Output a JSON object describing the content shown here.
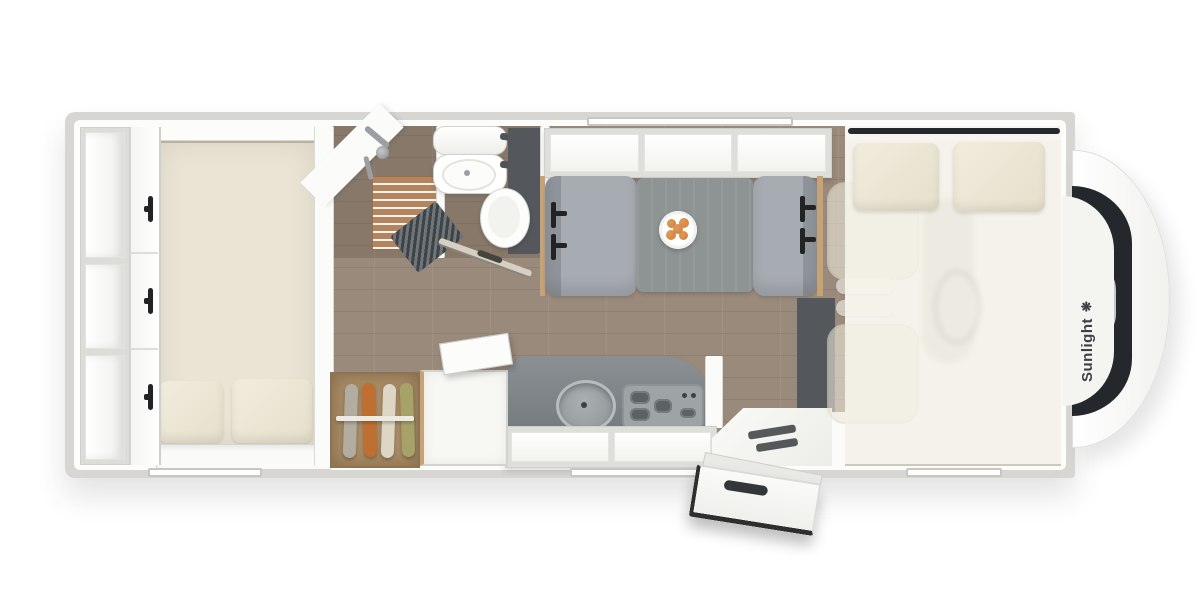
{
  "brand": {
    "name": "Sunlight",
    "logo_glyph": "❋"
  },
  "palette": {
    "bg": "#ffffff",
    "wall-outer": "#d7d6d3",
    "wall-face": "#fcfcfa",
    "bed-floor": "#eae4d5",
    "pillow": "#f1ecdd",
    "wood-floor": "#9a8a7b",
    "slat-wood": "#b3845e",
    "oak-trim": "#c6a377",
    "dark-panel": "#54585c",
    "bench": "#a7acb2",
    "bench-dark": "#8e949a",
    "table": "#8e9394",
    "counter": "#767c7f",
    "steel": "#9ea4a6",
    "belt": "#232323",
    "toilet": "#fdfdfb",
    "cab-seat": "#ece8db",
    "brand-text": "#3c4146",
    "glass": "#24272b",
    "food": "#cd7f3c",
    "cloth-gray": "#b3aca0",
    "cloth-orange": "#bf7030",
    "cloth-cream": "#ddd6c4",
    "cloth-olive": "#a7a368",
    "window-frame": "#c6c6c3"
  },
  "floorplan": {
    "view": "top-down",
    "vehicle": "motorhome",
    "zones": [
      {
        "id": "rear-bedroom",
        "items": [
          "bed",
          "two-pillows",
          "wardrobe-cabinets",
          "open-shelves",
          "foot-shelf",
          "window"
        ]
      },
      {
        "id": "bathroom",
        "items": [
          "shower-with-teak-grate",
          "shower-fixture",
          "washbasin-with-mirror",
          "toilet",
          "folding-door",
          "dark-partition"
        ]
      },
      {
        "id": "midship",
        "items": [
          "hanging-wardrobe-with-four-garments",
          "refrigerator-with-open-lid",
          "kitchen-counter",
          "round-sink",
          "three-burner-hob",
          "overhead-lockers",
          "window"
        ]
      },
      {
        "id": "dinette",
        "items": [
          "two-bench-seats-with-seatbelts",
          "table",
          "plate-of-food",
          "three-overhead-lockers",
          "window"
        ]
      },
      {
        "id": "entrance",
        "items": [
          "open-entry-door-with-handle",
          "entry-step",
          "dark-step-well"
        ]
      },
      {
        "id": "cab",
        "items": [
          "driver-seat",
          "passenger-seat",
          "steering-wheel",
          "dashboard",
          "drop-down-bed",
          "two-pillows",
          "windshield",
          "brand-lettering"
        ]
      }
    ]
  }
}
